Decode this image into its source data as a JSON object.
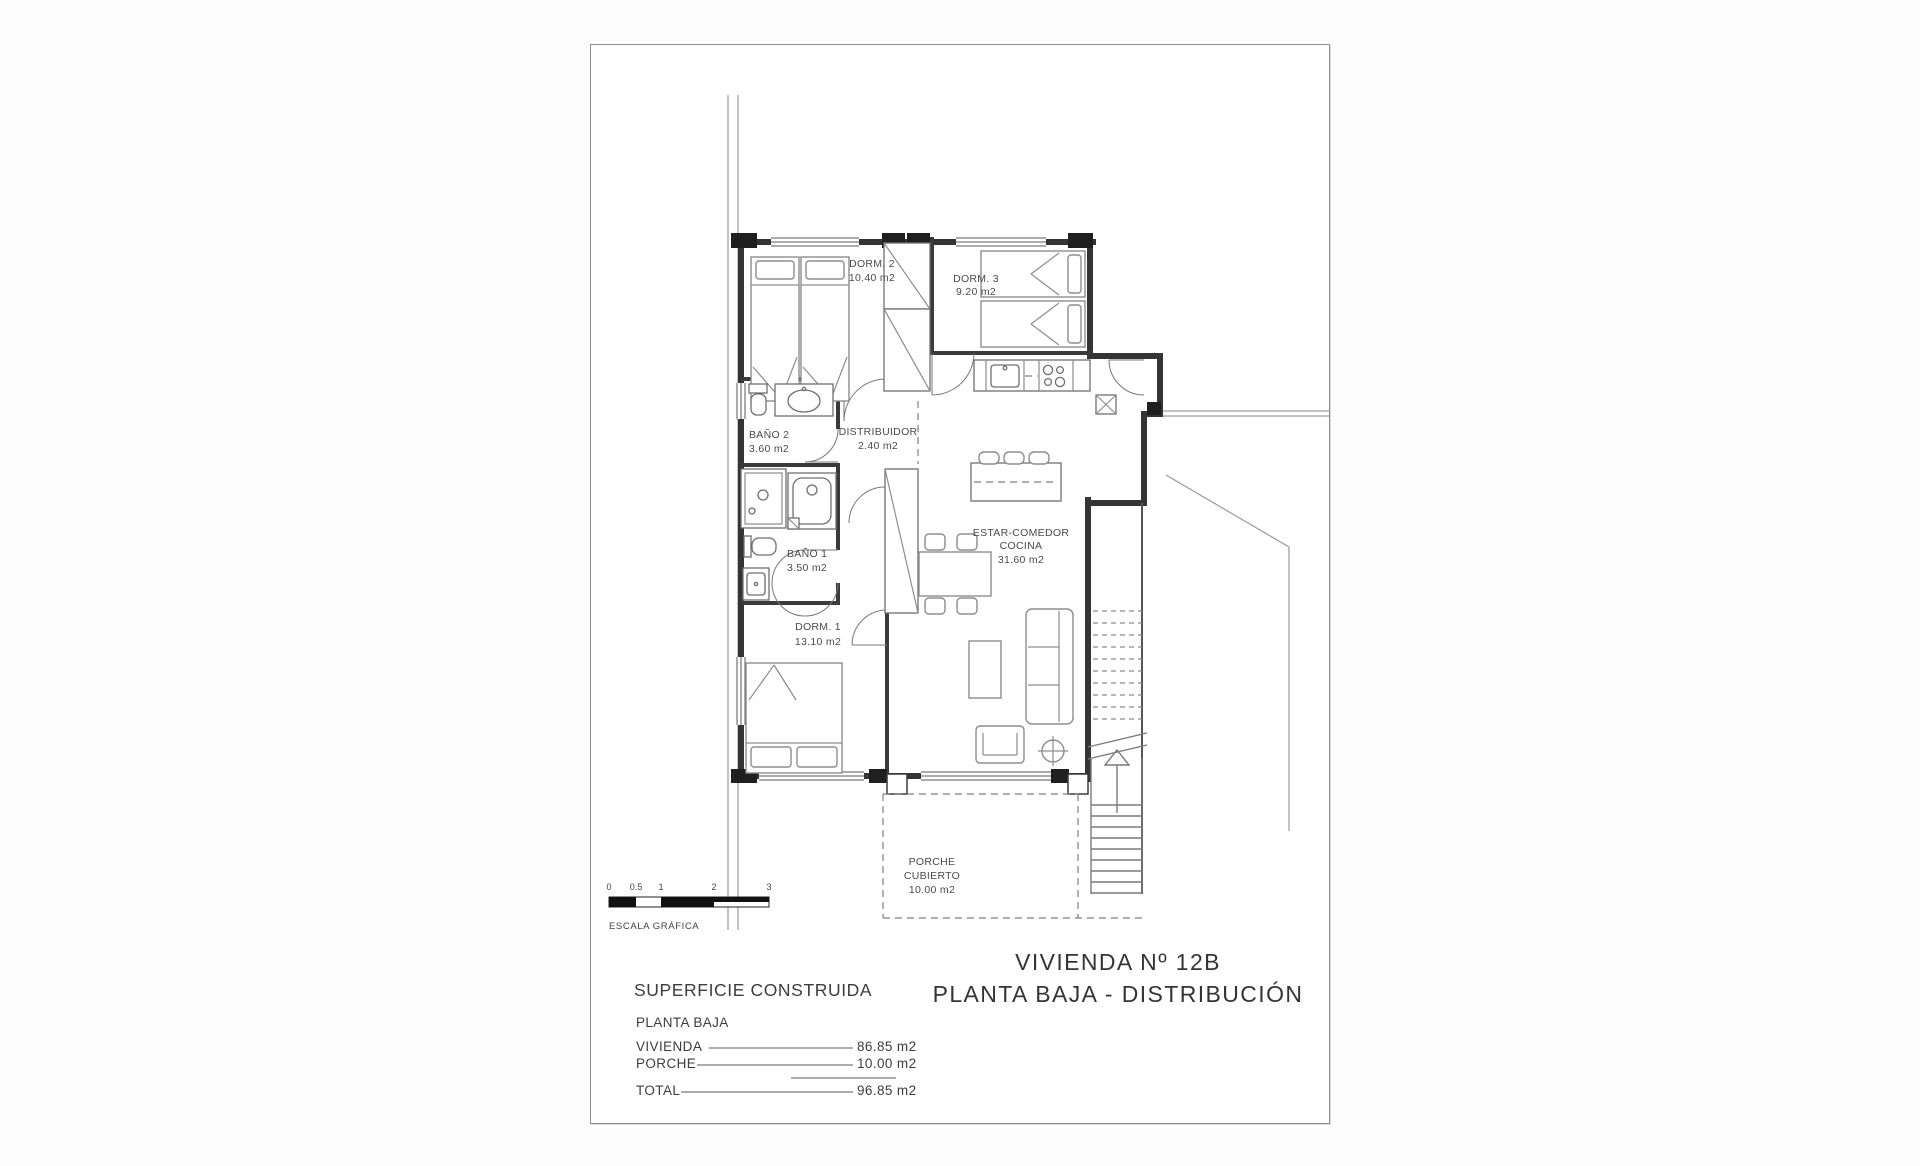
{
  "title": {
    "line1": "VIVIENDA Nº 12B",
    "line2": "PLANTA BAJA - DISTRIBUCIÓN"
  },
  "rooms": {
    "dorm2": {
      "name": "DORM. 2",
      "area": "10.40 m2"
    },
    "dorm3": {
      "name": "DORM. 3",
      "area": "9.20 m2"
    },
    "bano2": {
      "name": "BAÑO 2",
      "area": "3.60 m2"
    },
    "distribuidor": {
      "name": "DISTRIBUIDOR",
      "area": "2.40 m2"
    },
    "bano1": {
      "name": "BAÑO 1",
      "area": "3.50 m2"
    },
    "dorm1": {
      "name": "DORM. 1",
      "area": "13.10 m2"
    },
    "estar": {
      "name_line1": "ESTAR-COMEDOR",
      "name_line2": "COCINA",
      "area": "31.60 m2"
    },
    "porche": {
      "name_line1": "PORCHE",
      "name_line2": "CUBIERTO",
      "area": "10.00 m2"
    }
  },
  "scale_bar": {
    "ticks": [
      "0",
      "0.5",
      "1",
      "2",
      "3"
    ],
    "label": "ESCALA GRÁFICA"
  },
  "summary": {
    "title": "SUPERFICIE CONSTRUIDA",
    "subtitle": "PLANTA BAJA",
    "rows": [
      {
        "label": "VIVIENDA",
        "value": "86.85 m2"
      },
      {
        "label": "PORCHE",
        "value": "10.00 m2"
      }
    ],
    "total_label": "TOTAL",
    "total_value": "96.85 m2"
  },
  "colors": {
    "ink": "#343434",
    "paper": "#ffffff",
    "light_line": "#8d8d8d"
  }
}
